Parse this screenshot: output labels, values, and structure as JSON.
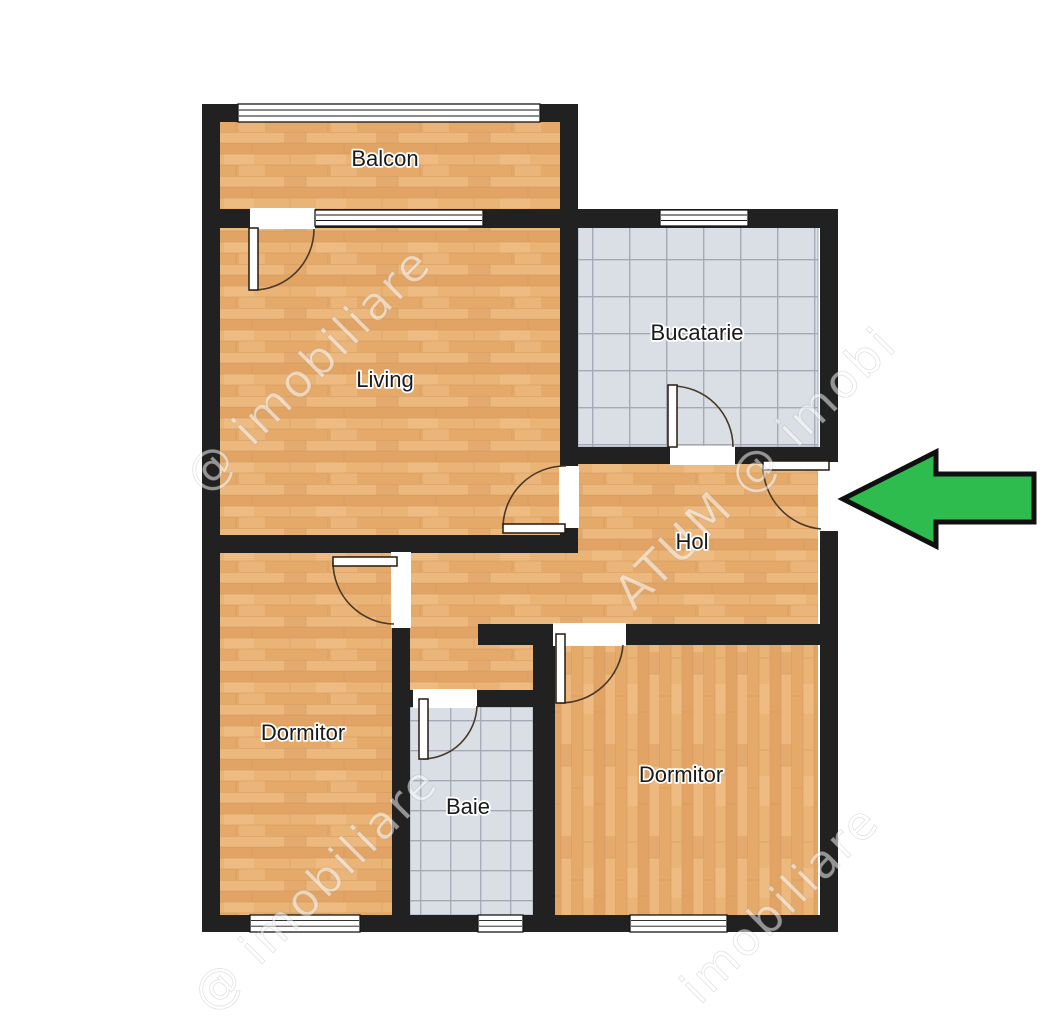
{
  "page": {
    "type": "apartment floor plan",
    "background": "#ffffff"
  },
  "rooms": [
    {
      "label": "Balcon",
      "floor": "wood"
    },
    {
      "label": "Living",
      "floor": "wood"
    },
    {
      "label": "Bucatarie",
      "floor": "tile"
    },
    {
      "label": "Hol",
      "floor": "wood"
    },
    {
      "label": "Dormitor",
      "floor": "wood"
    },
    {
      "label": "Baie",
      "floor": "tile"
    },
    {
      "label": "Dormitor",
      "floor": "wood"
    }
  ],
  "watermarks": [
    "@ imobiliare",
    "ATUM @ imobi",
    "@ imobiliare",
    "imobiliare"
  ],
  "arrow": {
    "fill": "#2ebc4f",
    "outline": "#101010",
    "direction": "left"
  },
  "colors": {
    "wall": "#212121",
    "wood": "#e8af71",
    "tile": "#dadfe5",
    "tile_grid": "#a3aab6",
    "door_arc": "#4a3826",
    "window_frame": "#161616"
  }
}
